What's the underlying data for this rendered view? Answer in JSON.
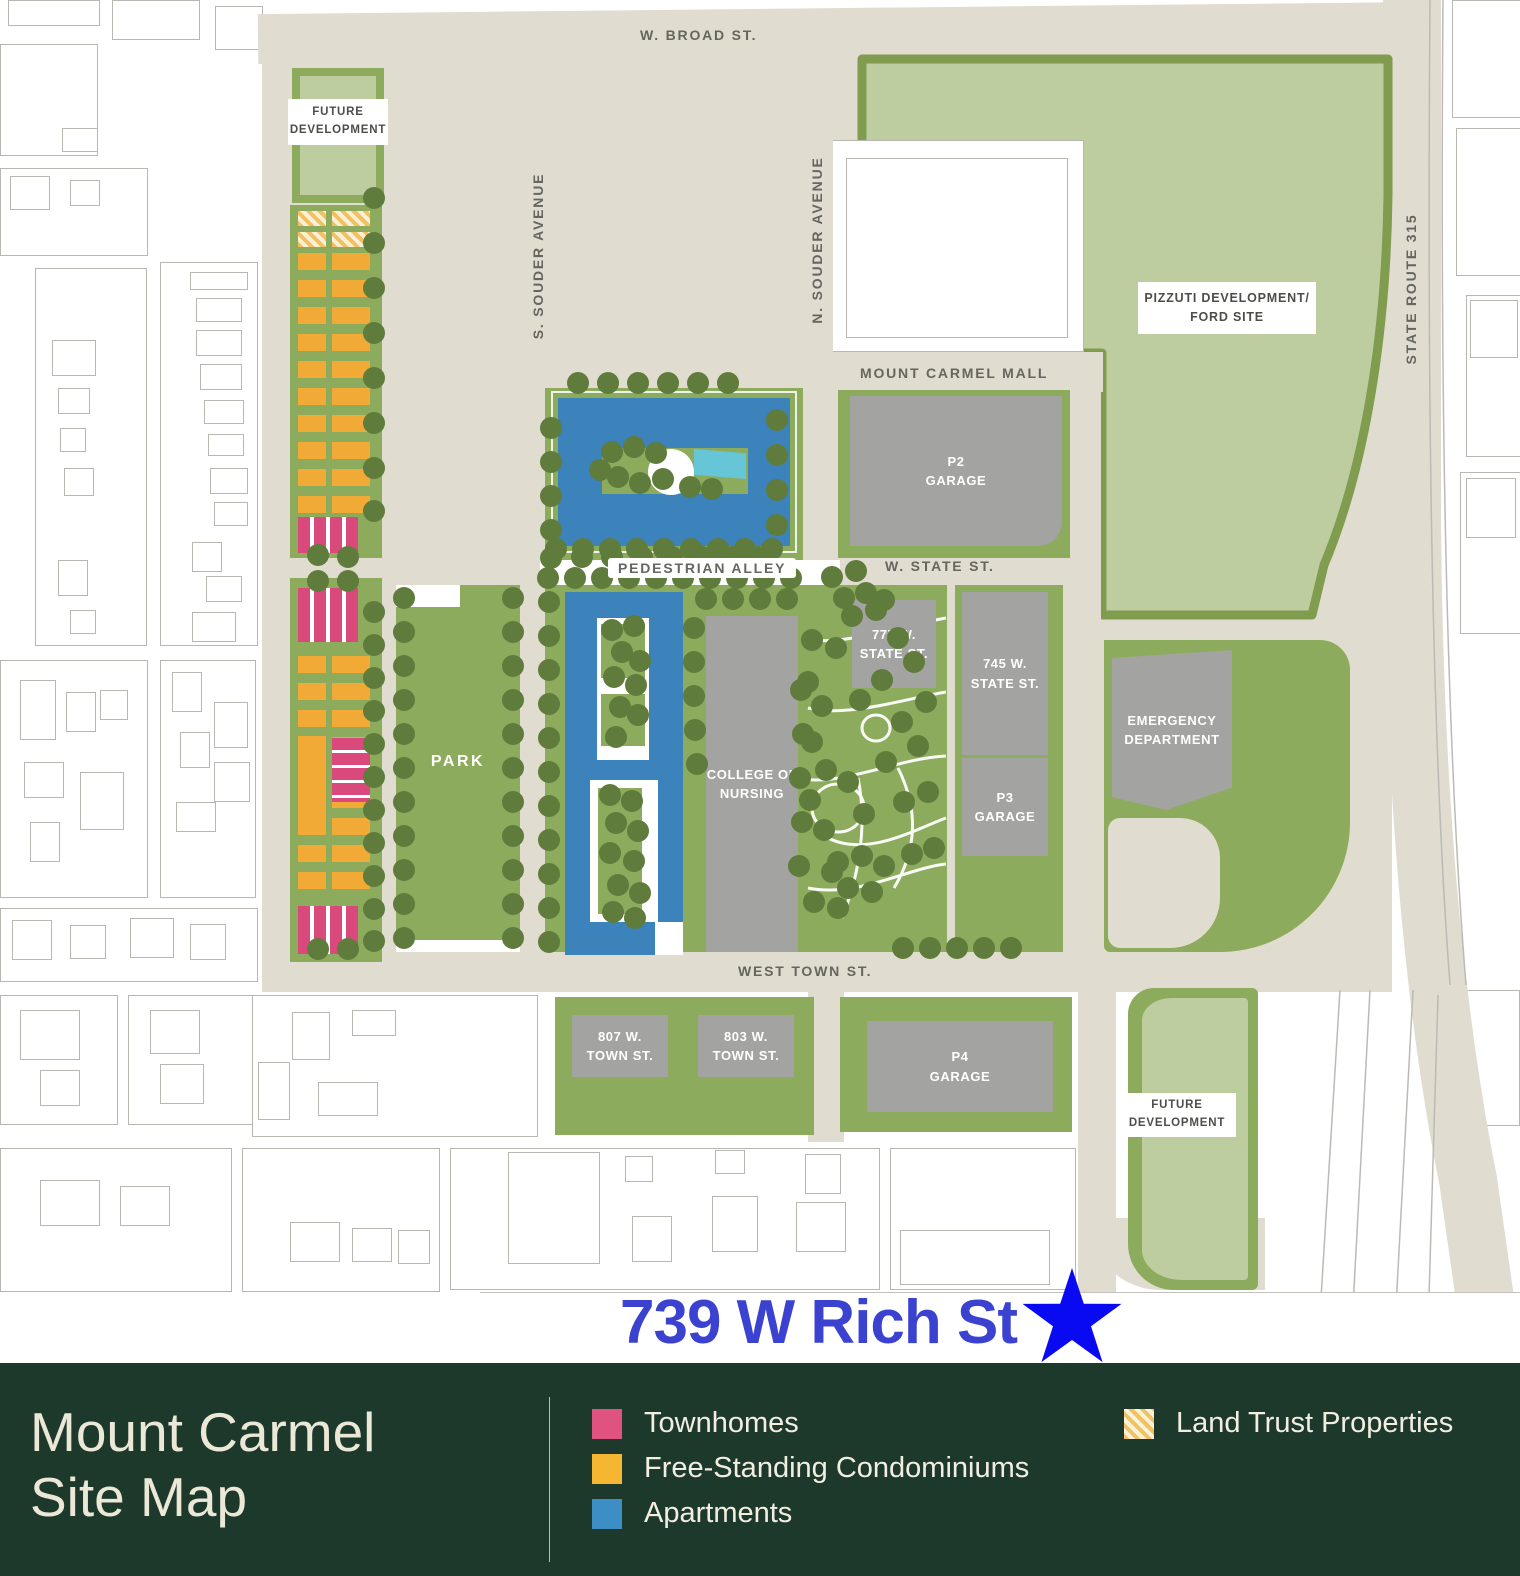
{
  "map": {
    "streets": {
      "w_broad": "W. BROAD ST.",
      "s_souder": "S. SOUDER AVENUE",
      "n_souder": "N. SOUDER AVENUE",
      "mount_carmel_mall": "MOUNT CARMEL MALL",
      "w_state": "W. STATE ST.",
      "pedestrian_alley": "PEDESTRIAN ALLEY",
      "west_town": "WEST TOWN ST.",
      "state_route_315": "STATE ROUTE 315"
    },
    "areas": {
      "future_top": {
        "l1": "FUTURE",
        "l2": "DEVELOPMENT"
      },
      "pizzuti": {
        "l1": "PIZZUTI DEVELOPMENT/",
        "l2": "FORD SITE"
      },
      "park": "PARK",
      "future_bottom": {
        "l1": "FUTURE",
        "l2": "DEVELOPMENT"
      }
    },
    "buildings": {
      "p2": {
        "l1": "P2",
        "l2": "GARAGE"
      },
      "b777": {
        "l1": "777 W.",
        "l2": "STATE ST."
      },
      "b745": {
        "l1": "745 W.",
        "l2": "STATE ST."
      },
      "p3": {
        "l1": "P3",
        "l2": "GARAGE"
      },
      "emergency": {
        "l1": "EMERGENCY",
        "l2": "DEPARTMENT"
      },
      "college": {
        "l1": "COLLEGE OF",
        "l2": "NURSING"
      },
      "b807": {
        "l1": "807 W.",
        "l2": "TOWN ST."
      },
      "b803": {
        "l1": "803 W.",
        "l2": "TOWN ST."
      },
      "p4": {
        "l1": "P4",
        "l2": "GARAGE"
      }
    }
  },
  "annotation": {
    "address": "739 W Rich St",
    "color": "#3b42cf",
    "star_color": "#0a0af2"
  },
  "footer": {
    "title_line1": "Mount Carmel",
    "title_line2": "Site Map",
    "legend": [
      {
        "label": "Townhomes",
        "color": "#e0527f",
        "hatched": false
      },
      {
        "label": "Free-Standing Condominiums",
        "color": "#f5b731",
        "hatched": false
      },
      {
        "label": "Apartments",
        "color": "#3d8ec4",
        "hatched": false
      },
      {
        "label": "Land Trust Properties",
        "color": "#f0c261",
        "hatched": true
      }
    ]
  }
}
